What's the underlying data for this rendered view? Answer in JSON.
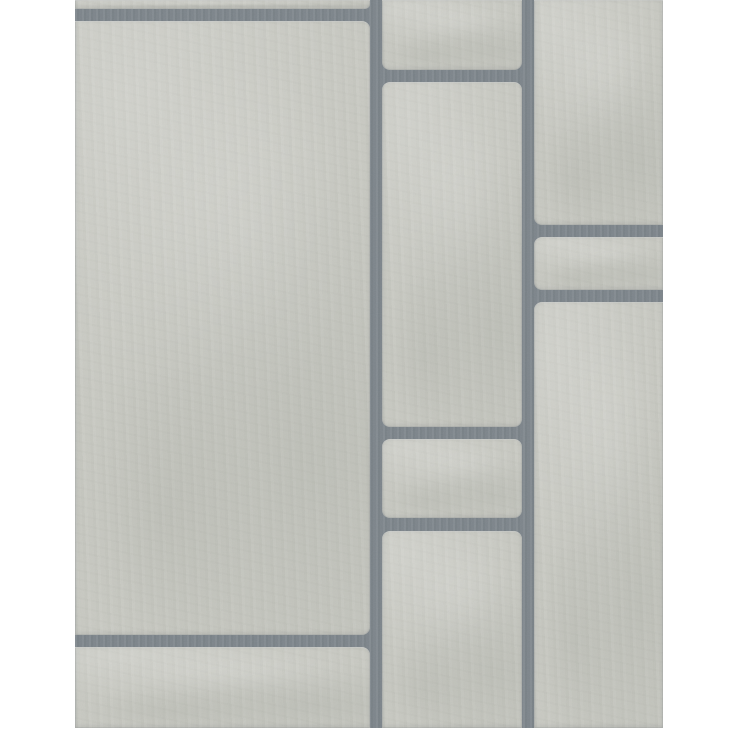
{
  "meta": {
    "type": "product-photo",
    "subject": "Grey stone tile effect wallpaper swatch",
    "canvas": {
      "width": 736,
      "height": 736,
      "background_color": "#ffffff"
    }
  },
  "wallpaper": {
    "left": 75,
    "top": 0,
    "width": 588,
    "height": 728,
    "grout_color": "#7d858b",
    "tile_color": "#c8c9c2",
    "tile_highlight_color": "#d2d3cc",
    "tile_shadow_color": "#bcbeb7",
    "grout_width": 12,
    "corner_radius": 8
  },
  "tiles": [
    {
      "id": "tile-left-top-sliver",
      "x": 0,
      "y": 0,
      "w": 295,
      "h": 9,
      "radius": [
        0,
        0,
        5,
        0
      ]
    },
    {
      "id": "tile-left-large",
      "x": 0,
      "y": 21,
      "w": 295,
      "h": 614,
      "radius": [
        0,
        8,
        8,
        0
      ]
    },
    {
      "id": "tile-left-bottom",
      "x": 0,
      "y": 647,
      "w": 295,
      "h": 81,
      "radius": [
        0,
        8,
        0,
        0
      ]
    },
    {
      "id": "tile-middle-top",
      "x": 307,
      "y": 0,
      "w": 140,
      "h": 70,
      "radius": [
        0,
        0,
        8,
        8
      ]
    },
    {
      "id": "tile-middle-tall",
      "x": 307,
      "y": 82,
      "w": 140,
      "h": 345,
      "radius": [
        8,
        8,
        8,
        8
      ]
    },
    {
      "id": "tile-middle-small",
      "x": 307,
      "y": 439,
      "w": 140,
      "h": 79,
      "radius": [
        8,
        8,
        8,
        8
      ]
    },
    {
      "id": "tile-middle-bottom",
      "x": 307,
      "y": 531,
      "w": 140,
      "h": 197,
      "radius": [
        8,
        8,
        0,
        0
      ]
    },
    {
      "id": "tile-right-top",
      "x": 459,
      "y": 0,
      "w": 129,
      "h": 225,
      "radius": [
        0,
        0,
        0,
        8
      ]
    },
    {
      "id": "tile-right-short",
      "x": 459,
      "y": 237,
      "w": 129,
      "h": 53,
      "radius": [
        8,
        0,
        0,
        8
      ]
    },
    {
      "id": "tile-right-large",
      "x": 459,
      "y": 302,
      "w": 129,
      "h": 426,
      "radius": [
        8,
        0,
        0,
        0
      ]
    }
  ]
}
